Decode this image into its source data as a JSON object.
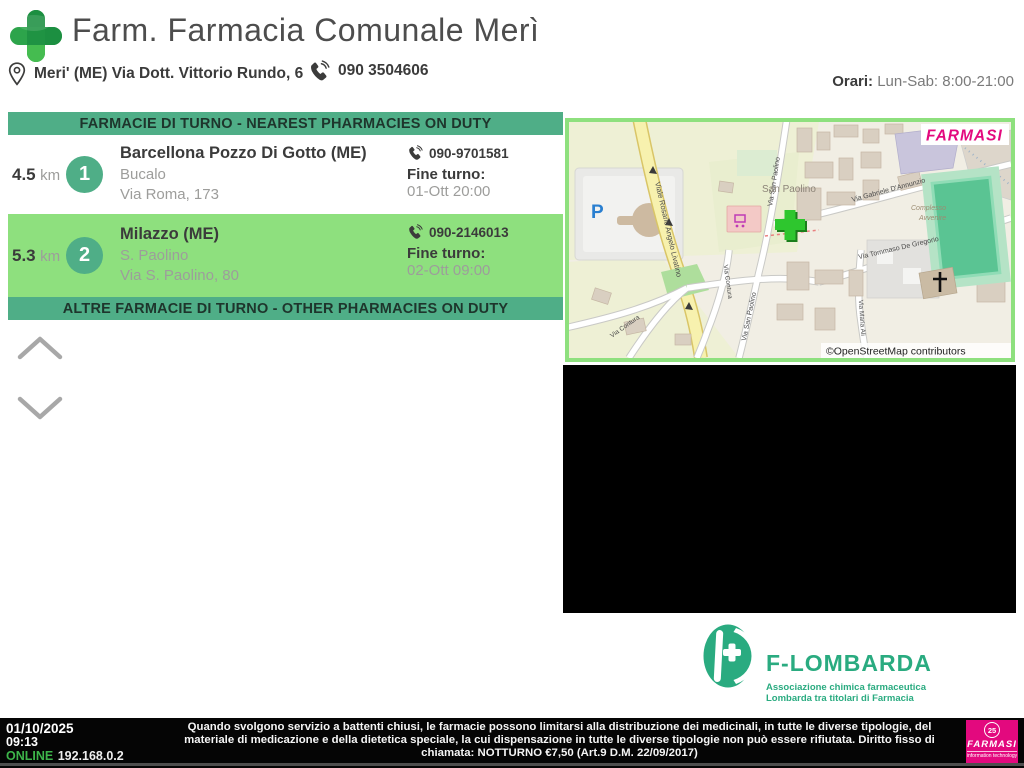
{
  "header": {
    "title": "Farm. Farmacia Comunale Merì",
    "address": "Meri' (ME) Via Dott. Vittorio Rundo, 6",
    "phone": "090 3504606",
    "hours_label": "Orari:",
    "hours_value": "Lun-Sab: 8:00-21:00"
  },
  "pharmacy_list": {
    "nearest_header": "FARMACIE DI TURNO - NEAREST PHARMACIES ON DUTY",
    "other_header": "ALTRE FARMACIE DI TURNO - OTHER PHARMACIES ON DUTY",
    "fine_turno_label": "Fine turno:",
    "rows": [
      {
        "distance": "4.5",
        "distance_unit": "km",
        "number": "1",
        "city": "Barcellona Pozzo Di Gotto (ME)",
        "name": "Bucalo",
        "street": "Via Roma, 173",
        "phone": "090-9701581",
        "fine_turno": "01-Ott 20:00"
      },
      {
        "distance": "5.3",
        "distance_unit": "km",
        "number": "2",
        "city": "Milazzo (ME)",
        "name": "S. Paolino",
        "street": "Via S. Paolino, 80",
        "phone": "090-2146013",
        "fine_turno": "02-Ott 09:00"
      }
    ]
  },
  "map": {
    "watermark": "FARMASI",
    "attribution": "©OpenStreetMap contributors",
    "place_label": "San Paolino",
    "parking_label": "P",
    "complex_line1": "Complesso",
    "complex_line2": "Avvenire",
    "streets": {
      "livatino": "Viale Rosario Angelo Livatino",
      "san_paolino": "Via San Paolino",
      "dannunzio": "Via Gabriele D'Annunzio",
      "de_gregorio": "Via Tommaso De Gregorio",
      "contura": "Via Contura",
      "maria": "Via Maria Ali"
    }
  },
  "association": {
    "name": "F-LOMBARDA",
    "line1": "Associazione chimica farmaceutica",
    "line2": "Lombarda tra titolari di Farmacia"
  },
  "status": {
    "date": "01/10/2025",
    "time": "09:13",
    "online_label": "ONLINE",
    "ip": "192.168.0.2",
    "message": "Quando svolgono servizio a battenti chiusi, le farmacie possono limitarsi alla distribuzione dei medicinali, in tutte le diverse tipologie, del materiale di medicazione e della dietetica speciale, la cui dispensazione in tutte le diverse tipologie non può essere rifiutata. Diritto fisso di chiamata: NOTTURNO €7,50 (Art.9 D.M. 22/09/2017)",
    "brand_badge": "25",
    "brand_name": "FARMASI",
    "brand_tagline": "information technology"
  },
  "colors": {
    "accent_green": "#4fae87",
    "highlight_green": "#8ee07e",
    "cross_green": "#2da14a",
    "online_green": "#3db54a",
    "brand_magenta": "#e3097e",
    "association_green": "#2aab80",
    "marker_green": "#2dbb2d"
  }
}
